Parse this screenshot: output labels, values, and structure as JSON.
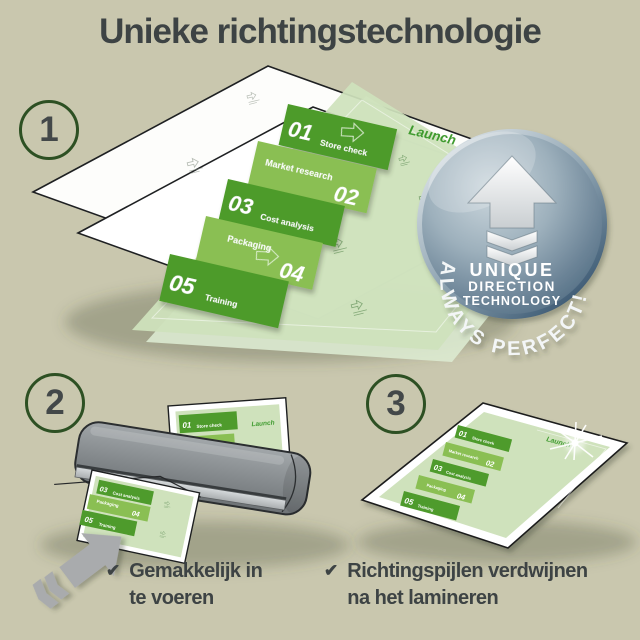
{
  "title": "Unieke richtingstechnologie",
  "steps": [
    "1",
    "2",
    "3"
  ],
  "doc": {
    "launch": "Launch",
    "items": [
      {
        "num": "01",
        "label": "Store check"
      },
      {
        "num": "02",
        "label": "Market research"
      },
      {
        "num": "03",
        "label": "Cost analysis"
      },
      {
        "num": "04",
        "label": "Packaging"
      },
      {
        "num": "05",
        "label": "Training"
      }
    ]
  },
  "badge": {
    "arc": "ALWAYS PERFECT!",
    "line1": "UNIQUE",
    "line2": "DIRECTION",
    "line3": "TECHNOLOGY"
  },
  "checklist": {
    "check_glyph": "✔",
    "item1_line1": "Gemakkelijk in",
    "item1_line2": "te voeren",
    "item2_line1": "Richtingspijlen verdwijnen",
    "item2_line2": "na het lamineren"
  },
  "colors": {
    "background": "#c9c7ae",
    "text_dark": "#3d4344",
    "circle_ring_green": "#2d5023",
    "doc_green_light": "#cfe2bc",
    "band_green_dark": "#4e9b2c",
    "band_green_mid": "#8abf53",
    "launch_green": "#3f9b2f",
    "badge_blue_gray": "#6d8598",
    "laminator_gray": "#8b9093",
    "arrow_gray": "#a9abad"
  }
}
